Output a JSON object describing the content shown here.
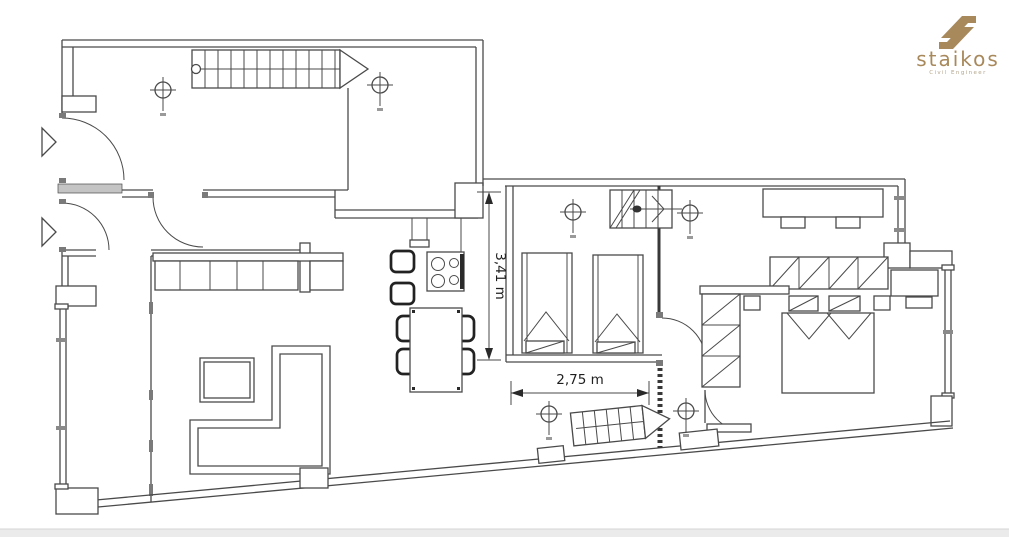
{
  "logo": {
    "brand": "staikos",
    "tagline": "Civil Engineer"
  },
  "plan": {
    "dimension_vertical_label": "3,41 m",
    "dimension_horizontal_label": "2,75 m"
  },
  "colors": {
    "ink": "#4a4a4a",
    "dark": "#2a2a2a",
    "gold": "#a8895c",
    "gold_muted": "#b3a48a",
    "footer_bar": "#ebebeb",
    "footer_border": "#d4d4d4"
  }
}
